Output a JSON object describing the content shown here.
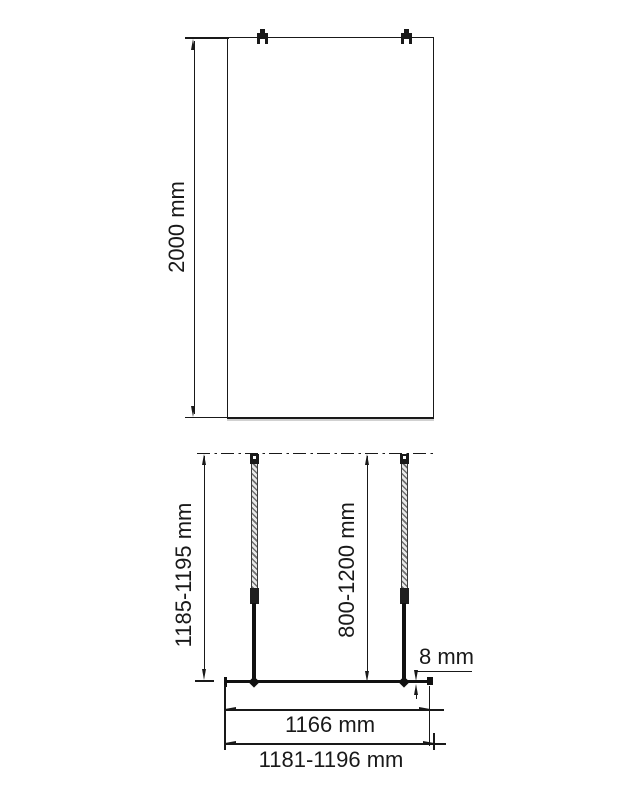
{
  "page": {
    "background_color": "#ffffff",
    "line_color": "#191919"
  },
  "drawing": {
    "type": "shower-screen-installation-dimensions",
    "front_view": {
      "height_label": "2000 mm"
    },
    "plan_view": {
      "install_height_label": "1185-1195 mm",
      "support_bar_label": "800-1200 mm",
      "glass_thickness_label": "8 mm",
      "glass_width_label": "1166 mm",
      "total_width_label": "1181-1196 mm"
    }
  }
}
